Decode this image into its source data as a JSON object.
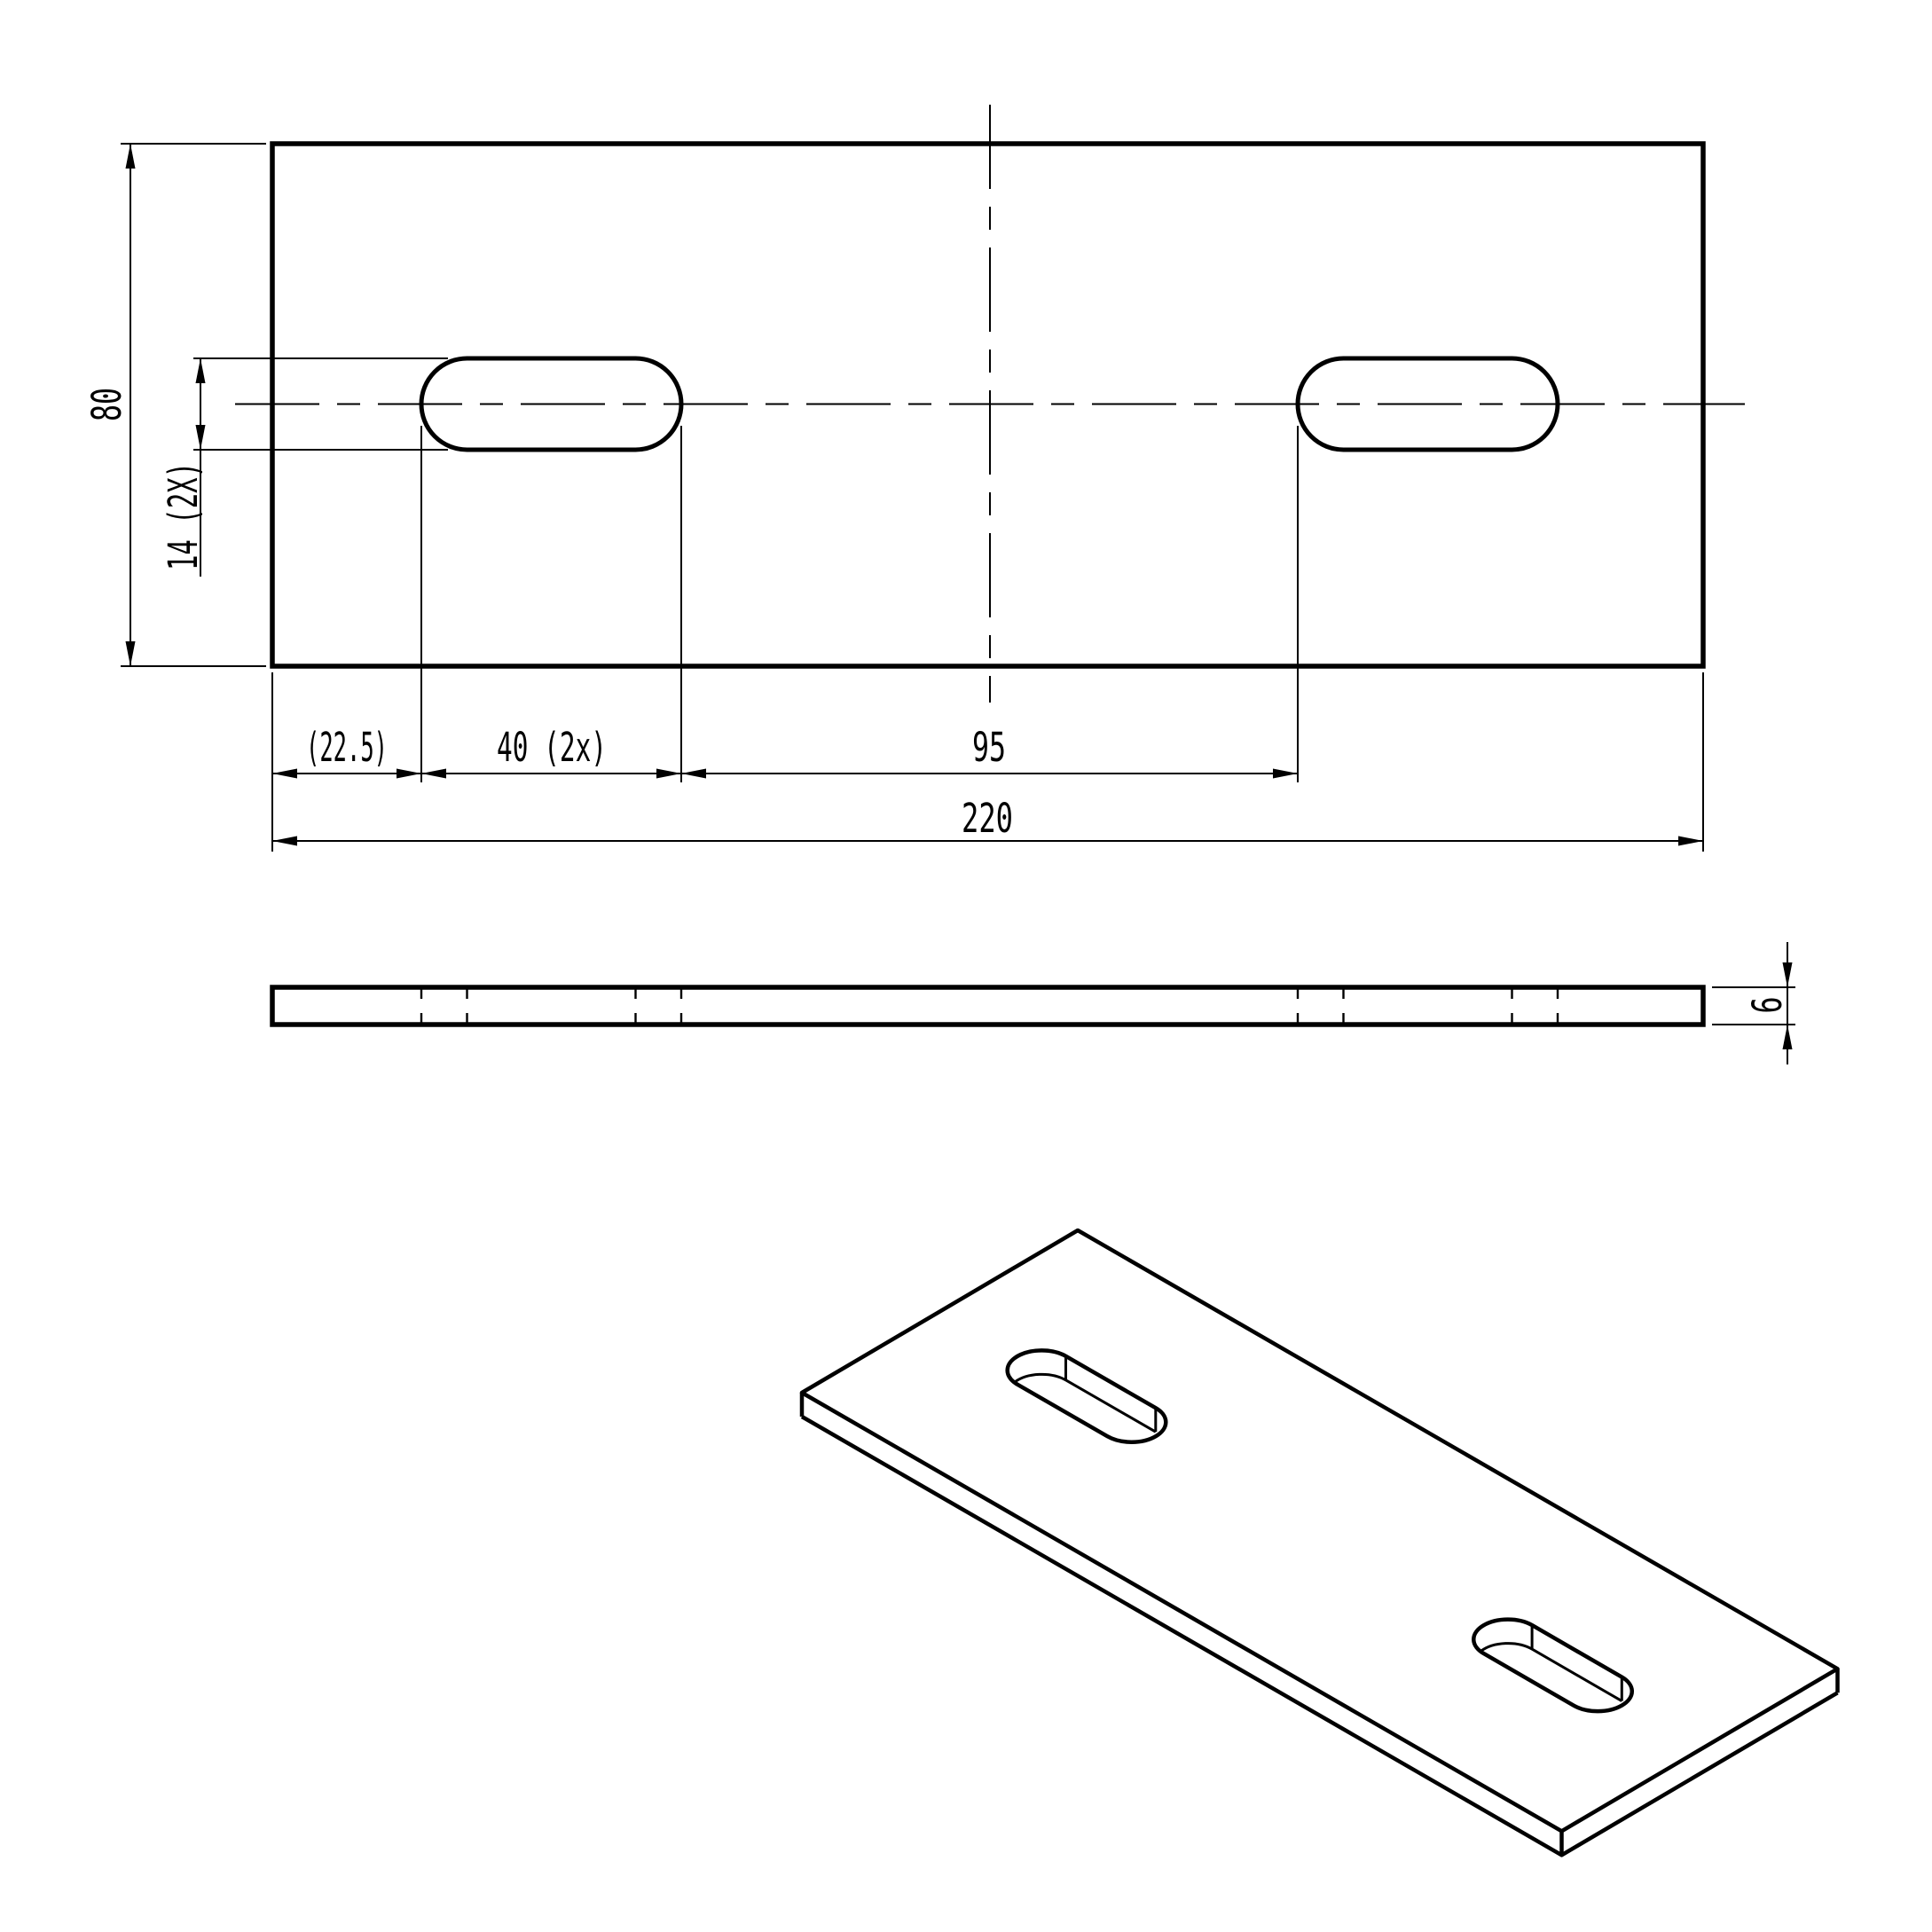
{
  "page": {
    "background_color": "#ffffff",
    "stroke_color": "#000000"
  },
  "drawing": {
    "front_view": {
      "dim_height": "80",
      "dim_slot_width": "14 (2X)",
      "dim_edge_offset": "(22.5)",
      "dim_slot_length": "40 (2x)",
      "dim_slot_spacing": "95",
      "dim_total_length": "220"
    },
    "side_view": {
      "dim_thickness": "6"
    }
  }
}
